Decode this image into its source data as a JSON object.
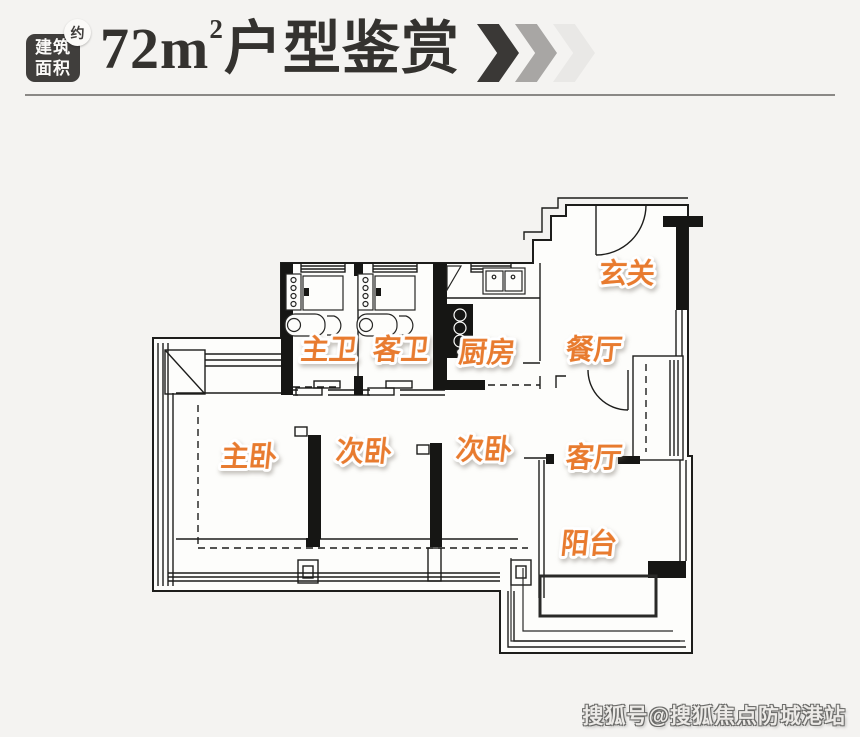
{
  "header": {
    "area_badge": {
      "line1": "建筑",
      "line2": "面积",
      "approx": "约"
    },
    "title": {
      "number": "72m",
      "superscript": "2",
      "text": "户型鉴赏"
    },
    "chevrons": [
      "#3a3836",
      "#a8a6a4",
      "#e9e8e6"
    ],
    "divider_color": "#8a8886"
  },
  "floorplan": {
    "wall_color": "#1d1d1b",
    "label_style": {
      "color": "#e87b2f",
      "outline": "#ffffff"
    },
    "rooms": [
      {
        "id": "entry",
        "label": "玄关"
      },
      {
        "id": "master-bath",
        "label": "主卫"
      },
      {
        "id": "guest-bath",
        "label": "客卫"
      },
      {
        "id": "kitchen",
        "label": "厨房"
      },
      {
        "id": "dining",
        "label": "餐厅"
      },
      {
        "id": "master-bedroom",
        "label": "主卧"
      },
      {
        "id": "bedroom-2",
        "label": "次卧"
      },
      {
        "id": "bedroom-3",
        "label": "次卧"
      },
      {
        "id": "living-room",
        "label": "客厅"
      },
      {
        "id": "balcony",
        "label": "阳台"
      }
    ]
  },
  "watermark": {
    "text": "搜狐号@搜狐焦点防城港站"
  }
}
